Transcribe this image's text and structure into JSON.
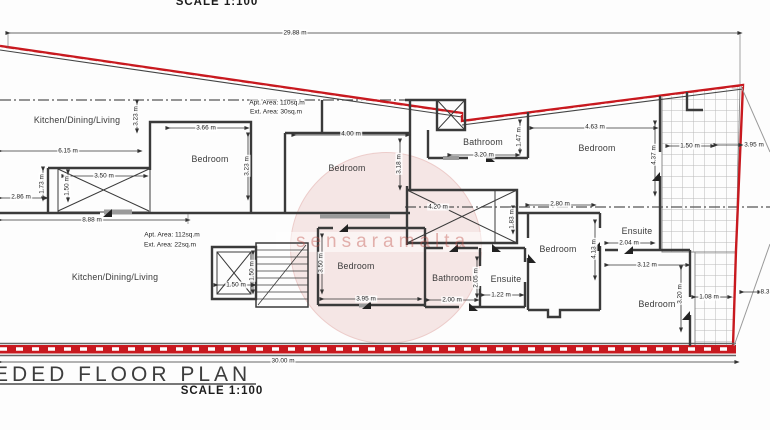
{
  "header": {
    "scale_label": "SCALE 1:100"
  },
  "footer": {
    "plan_title": "EDED FLOOR PLAN",
    "scale_label": "SCALE 1:100"
  },
  "watermark": {
    "text": "sensaramalta"
  },
  "colors": {
    "boundary_red": "#c8191f",
    "wall_gray": "#3a3a3a",
    "tile_gray": "#b9b9b9"
  },
  "area_notes": [
    {
      "text": "Apt. Area: 110sq.m",
      "x": 277,
      "y": 103
    },
    {
      "text": "Ext. Area: 30sq.m",
      "x": 276,
      "y": 112
    },
    {
      "text": "Apt. Area: 112sq.m",
      "x": 172,
      "y": 235
    },
    {
      "text": "Ext. Area: 22sq.m",
      "x": 170,
      "y": 245
    }
  ],
  "room_labels": [
    {
      "text": "Kitchen/Dining/Living",
      "x": 77,
      "y": 120
    },
    {
      "text": "Bedroom",
      "x": 210,
      "y": 159
    },
    {
      "text": "Bedroom",
      "x": 347,
      "y": 168
    },
    {
      "text": "Bathroom",
      "x": 483,
      "y": 142
    },
    {
      "text": "Bedroom",
      "x": 597,
      "y": 148
    },
    {
      "text": "Kitchen/Dining/Living",
      "x": 115,
      "y": 277
    },
    {
      "text": "Bedroom",
      "x": 356,
      "y": 266
    },
    {
      "text": "Bathroom",
      "x": 452,
      "y": 278
    },
    {
      "text": "Ensuite",
      "x": 506,
      "y": 279
    },
    {
      "text": "Bedroom",
      "x": 558,
      "y": 249
    },
    {
      "text": "Ensuite",
      "x": 637,
      "y": 231
    },
    {
      "text": "Bedroom",
      "x": 657,
      "y": 304
    }
  ],
  "dim_labels": [
    {
      "text": "29.88 m",
      "x": 295,
      "y": 33,
      "rot": 0
    },
    {
      "text": "3.66 m",
      "x": 206,
      "y": 128,
      "rot": 0
    },
    {
      "text": "6.15 m",
      "x": 68,
      "y": 151,
      "rot": 0
    },
    {
      "text": "3.23 m",
      "x": 136,
      "y": 116,
      "rot": 1
    },
    {
      "text": "3.23 m",
      "x": 247,
      "y": 166,
      "rot": 1
    },
    {
      "text": "3.50 m",
      "x": 104,
      "y": 176,
      "rot": 0
    },
    {
      "text": "1.73 m",
      "x": 42,
      "y": 184,
      "rot": 1
    },
    {
      "text": "1.50 m",
      "x": 67,
      "y": 186,
      "rot": 1
    },
    {
      "text": "2.86 m",
      "x": 21,
      "y": 197,
      "rot": 0
    },
    {
      "text": "8.88 m",
      "x": 92,
      "y": 220,
      "rot": 0
    },
    {
      "text": "4.00 m",
      "x": 351,
      "y": 134,
      "rot": 0
    },
    {
      "text": "3.18 m",
      "x": 399,
      "y": 164,
      "rot": 1
    },
    {
      "text": "3.20 m",
      "x": 484,
      "y": 155,
      "rot": 0
    },
    {
      "text": "1.47 m",
      "x": 519,
      "y": 137,
      "rot": 1
    },
    {
      "text": "4.63 m",
      "x": 595,
      "y": 127,
      "rot": 0
    },
    {
      "text": "4.37 m",
      "x": 654,
      "y": 155,
      "rot": 1
    },
    {
      "text": "1.50 m",
      "x": 690,
      "y": 146,
      "rot": 0
    },
    {
      "text": "3.95 m",
      "x": 754,
      "y": 145,
      "rot": 0
    },
    {
      "text": "4.20 m",
      "x": 438,
      "y": 207,
      "rot": 0
    },
    {
      "text": "2.80 m",
      "x": 560,
      "y": 204,
      "rot": 0
    },
    {
      "text": "1.83 m",
      "x": 512,
      "y": 219,
      "rot": 1
    },
    {
      "text": "4.13 m",
      "x": 594,
      "y": 249,
      "rot": 1
    },
    {
      "text": "2.04 m",
      "x": 629,
      "y": 243,
      "rot": 0
    },
    {
      "text": "3.12 m",
      "x": 647,
      "y": 265,
      "rot": 0
    },
    {
      "text": "1.50 m",
      "x": 236,
      "y": 285,
      "rot": 0
    },
    {
      "text": "1.50 m",
      "x": 252,
      "y": 271,
      "rot": 1
    },
    {
      "text": "3.95 m",
      "x": 366,
      "y": 299,
      "rot": 0
    },
    {
      "text": "3.50 m",
      "x": 321,
      "y": 263,
      "rot": 1
    },
    {
      "text": "2.00 m",
      "x": 452,
      "y": 300,
      "rot": 0
    },
    {
      "text": "2.05 m",
      "x": 476,
      "y": 278,
      "rot": 1
    },
    {
      "text": "1.22 m",
      "x": 501,
      "y": 295,
      "rot": 0
    },
    {
      "text": "3.20 m",
      "x": 680,
      "y": 294,
      "rot": 1
    },
    {
      "text": "1.08 m",
      "x": 709,
      "y": 297,
      "rot": 0
    },
    {
      "text": "8.3",
      "x": 765,
      "y": 292,
      "rot": 0
    },
    {
      "text": "30.00 m",
      "x": 283,
      "y": 361,
      "rot": 0
    }
  ]
}
